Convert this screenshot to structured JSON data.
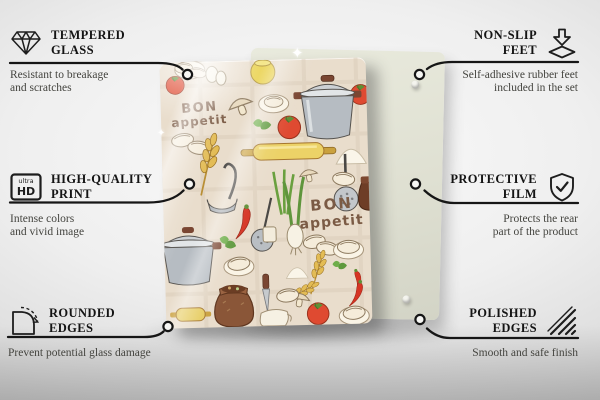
{
  "scene": {
    "type": "product infographic photo"
  },
  "board": {
    "print_word_top": "BON",
    "print_word_bottom": "appetit",
    "colors": {
      "glass_background": "#e9ddcc",
      "print_text_brown": "#7b5b45",
      "backing_board_green": "#dfe0d2",
      "pot_gray": "#b6bcc2",
      "tomato_red": "#df4a31",
      "rolling_pin_yellow": "#ecd267",
      "jug_brown": "#8a5638",
      "wheat_gold": "#e3bc55",
      "chili_red": "#d63524",
      "leaf_green": "#5f9a3e"
    }
  },
  "callouts": [
    {
      "id": "tempered-glass",
      "title": [
        "TEMPERED",
        "GLASS"
      ],
      "caption": [
        "Resistant to breakage",
        "and scratches"
      ],
      "icon": "diamond-icon"
    },
    {
      "id": "high-quality-print",
      "title": [
        "HIGH-QUALITY",
        "PRINT"
      ],
      "caption": [
        "Intense colors",
        "and vivid image"
      ],
      "icon": "ultra-hd-icon",
      "icon_text": {
        "top": "ultra",
        "bottom": "HD"
      }
    },
    {
      "id": "rounded-edges",
      "title": [
        "ROUNDED",
        "EDGES"
      ],
      "caption": [
        "Prevent potential glass damage"
      ],
      "icon": "rounded-corner-arrow-icon"
    },
    {
      "id": "non-slip-feet",
      "title": [
        "NON-SLIP",
        "FEET"
      ],
      "caption": [
        "Self-adhesive rubber feet",
        "included in the set"
      ],
      "icon": "arrow-onto-pad-icon"
    },
    {
      "id": "protective-film",
      "title": [
        "PROTECTIVE",
        "FILM"
      ],
      "caption": [
        "Protects the rear",
        "part of the product"
      ],
      "icon": "shield-check-icon"
    },
    {
      "id": "polished-edges",
      "title": [
        "POLISHED",
        "EDGES"
      ],
      "caption": [
        "Smooth and safe finish"
      ],
      "icon": "hatched-edge-icon"
    }
  ]
}
